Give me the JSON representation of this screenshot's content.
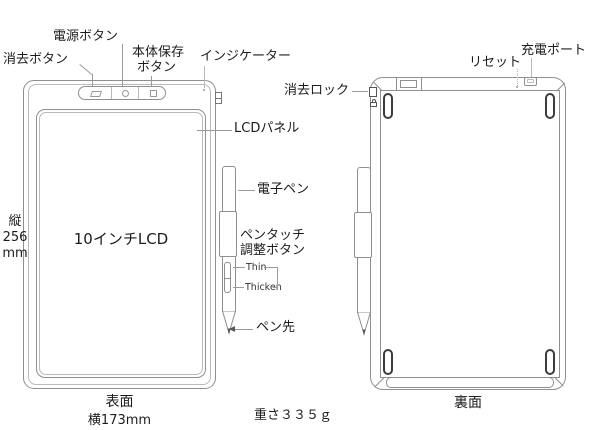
{
  "colors": {
    "outline": "#8f8f8f",
    "outline_light": "#b9b9b9",
    "leader": "#9a9a9a",
    "text": "#1c1c1c",
    "feet": "#3c3c3c"
  },
  "front": {
    "caption": "表面",
    "width_label": "横173mm",
    "height_label_lines": [
      "縦",
      "256",
      "mm"
    ],
    "screen_label": "10インチLCD",
    "labels": {
      "erase_button": "消去ボタン",
      "power_button": "電源ボタン",
      "save_button_lines": [
        "本体保存",
        "ボタン"
      ],
      "indicator": "インジケーター",
      "lcd_panel": "LCDパネル",
      "stylus": "電子ペン",
      "pen_adjust_lines": [
        "ペンタッチ",
        "調整ボタン"
      ],
      "pen_thin": "Thin",
      "pen_thicken": "Thicken",
      "pen_tip": "ペン先"
    }
  },
  "back": {
    "caption": "裏面",
    "labels": {
      "erase_lock": "消去ロック",
      "reset": "リセット",
      "charge_port": "充電ポート"
    }
  },
  "weight_label": "重さ３３５ｇ"
}
